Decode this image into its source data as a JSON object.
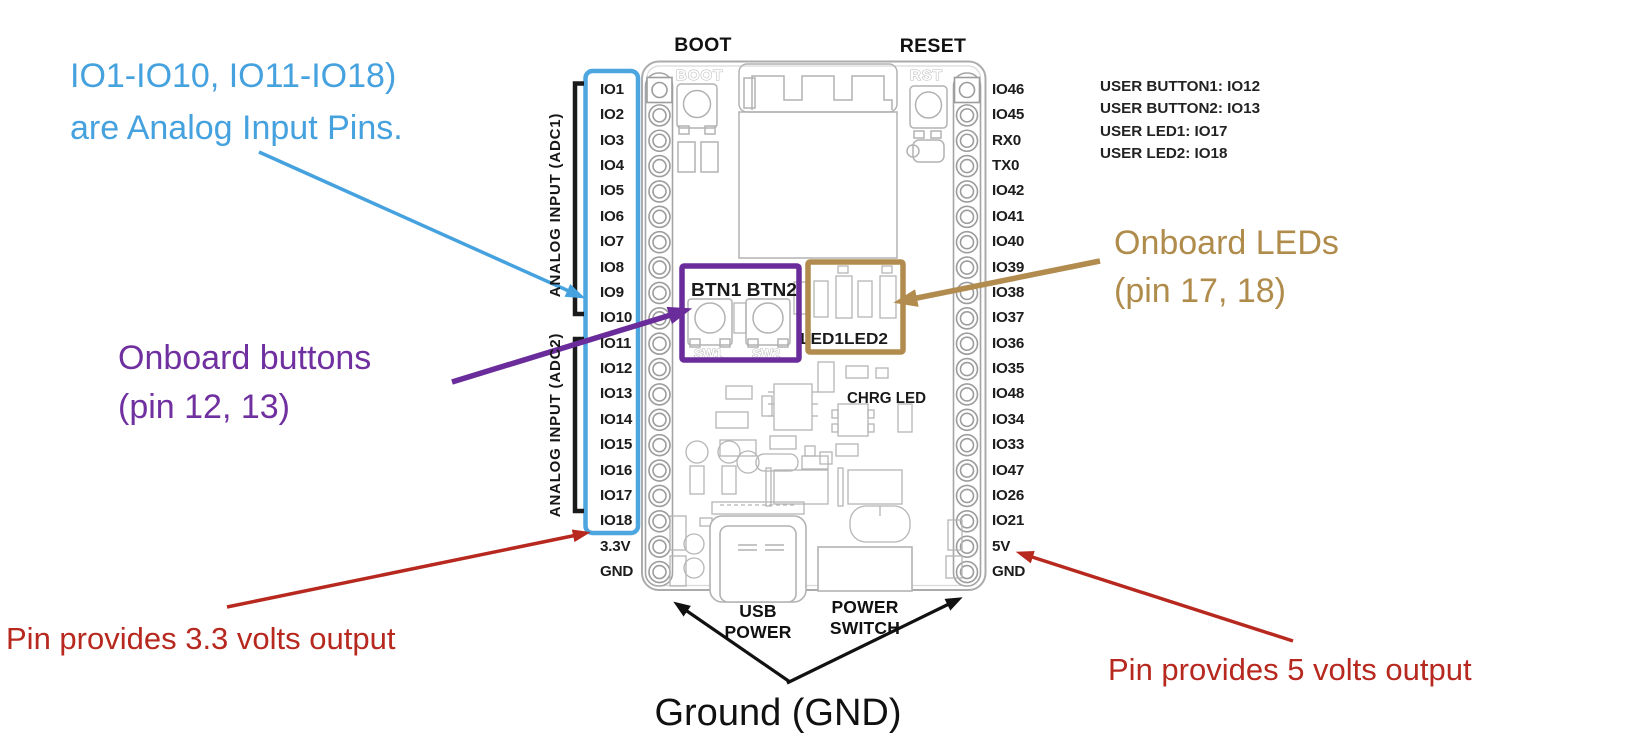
{
  "annotations": {
    "analog_note": {
      "line1": "IO1-IO10, IO11-IO18)",
      "line2": "are Analog Input Pins.",
      "color": "#46A2DF"
    },
    "buttons_note": {
      "line1": "Onboard buttons",
      "line2": "(pin 12, 13)",
      "color": "#7030A0"
    },
    "leds_note": {
      "line1": "Onboard LEDs",
      "line2": "(pin 17, 18)",
      "color": "#B08C4C"
    },
    "v33_note": {
      "text": "Pin provides 3.3 volts output",
      "color": "#B7281F"
    },
    "v5_note": {
      "text": "Pin provides 5 volts output",
      "color": "#B7281F"
    },
    "ground_note": {
      "text": "Ground (GND)"
    }
  },
  "user_info": {
    "lines": [
      "USER BUTTON1: IO12",
      "USER BUTTON2: IO13",
      "USER LED1: IO17",
      "USER LED2: IO18"
    ]
  },
  "board": {
    "top_labels": {
      "boot": "BOOT",
      "reset": "RESET"
    },
    "bottom_labels": {
      "usb_line1": "USB",
      "usb_line2": "POWER",
      "switch_line1": "POWER",
      "switch_line2": "SWITCH"
    },
    "silkscreen": {
      "boot": "BOOT",
      "rst": "RST",
      "btn": "BTN1 BTN2",
      "sw1": "SW1",
      "sw2": "SW2",
      "led": "LED1LED2",
      "chrg": "CHRG LED"
    }
  },
  "pin_groups": {
    "adc1": "ANALOG INPUT (ADC1)",
    "adc2": "ANALOG INPUT (ADC2)"
  },
  "pins": {
    "left": [
      "IO1",
      "IO2",
      "IO3",
      "IO4",
      "IO5",
      "IO6",
      "IO7",
      "IO8",
      "IO9",
      "IO10",
      "IO11",
      "IO12",
      "IO13",
      "IO14",
      "IO15",
      "IO16",
      "IO17",
      "IO18",
      "3.3V",
      "GND"
    ],
    "right": [
      "IO46",
      "IO45",
      "RX0",
      "TX0",
      "IO42",
      "IO41",
      "IO40",
      "IO39",
      "IO38",
      "IO37",
      "IO36",
      "IO35",
      "IO48",
      "IO34",
      "IO33",
      "IO47",
      "IO26",
      "IO21",
      "5V",
      "GND"
    ]
  },
  "colors": {
    "analog_highlight_box": "#4DA6E0",
    "buttons_highlight_box": "#6A2C9B",
    "leds_highlight_box": "#B18C4E",
    "voltage_arrows": "#B7281F",
    "board_lines": "#ABABAB",
    "text_black": "#1a1a1a"
  }
}
